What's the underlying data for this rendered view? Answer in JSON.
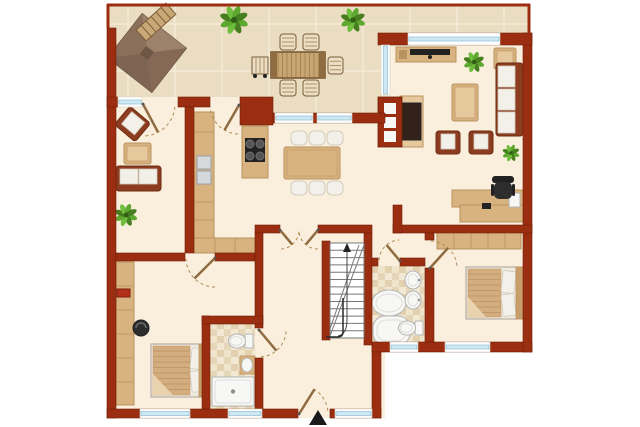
{
  "palette": {
    "wall": "#9B2E11",
    "wallStroke": "#701F08",
    "floor": "#FAEFDC",
    "tile": "#EADDC1",
    "grout": "#F4EBD8",
    "wood": "#D9B37F",
    "woodDark": "#B8925F",
    "woodLight": "#E6C89D",
    "woodDeep": "#8F6C41",
    "outWood": "#C7A674",
    "outWoodDark": "#71502C",
    "slat": "#A8854F",
    "endBoard": "#8F6C41",
    "fabric": "#8C3D20",
    "fabricDark": "#6E2B12",
    "cushion": "#F3F0E9",
    "cushionStroke": "#D3CCBC",
    "white": "#F7F7F5",
    "fixtureStroke": "#B5B5B5",
    "fixtureInner": "#DDDDDD",
    "glass": "#CFE9F4",
    "glassStroke": "#8FBDD3",
    "frame": "#FFFFFF",
    "green1": "#5FA830",
    "green2": "#477F20",
    "green3": "#6FBE3E",
    "greenDark": "#2F5E14",
    "dark": "#222222",
    "chairDark": "#2D2D2D",
    "gray": "#777777",
    "arc": "#B08A58",
    "duvet": "#D3AD7D",
    "duvetStripe": "#C2986A",
    "duvetFold": "#E9D3AE",
    "bathA": "#EFE4CC",
    "bathB": "#E2D0AE",
    "bathC": "#E6D6B8",
    "bathD": "#F2E8D4",
    "pergBase": "#907660",
    "pergN": "#9C816B",
    "pergS": "#7E6553",
    "pergW": "#8A6F5B",
    "pergE": "#866856",
    "pergStroke": "#6A5342",
    "pergCore": "#6F5745",
    "benchWood": "#C9A877",
    "benchStripe": "#7E5E36",
    "outChair": "#EADFC6",
    "outChairStroke": "#7A5B38",
    "outChairStripe": "#B09260",
    "appliance": "#D6D9DB",
    "applianceStroke": "#98A0A6",
    "red": "#B3301A",
    "redStroke": "#7E1E0C",
    "stair": "#FFFFFF",
    "stairLine": "#777777",
    "rail": "#2A2A2A"
  },
  "floorplan": {
    "canvas": {
      "w": 640,
      "h": 427
    },
    "house_floor": [
      {
        "x": 107,
        "y": 97,
        "w": 278,
        "h": 321
      },
      {
        "x": 372,
        "y": 33,
        "w": 160,
        "h": 319
      }
    ],
    "terrace": {
      "path": "M107,4 H530 V33 H381 V113 H240 V97 H107 Z",
      "gridStep": 47,
      "gridX0": 128,
      "gridY0": 24,
      "border": [
        {
          "x1": 107,
          "y1": 5,
          "x2": 530,
          "y2": 5
        },
        {
          "x1": 108,
          "y1": 4,
          "x2": 108,
          "y2": 28
        },
        {
          "x1": 529,
          "y1": 4,
          "x2": 529,
          "y2": 33
        }
      ]
    },
    "bath_floors": [
      {
        "x": 210,
        "y": 324,
        "w": 45,
        "h": 85
      },
      {
        "x": 372,
        "y": 266,
        "w": 53,
        "h": 79
      }
    ],
    "walls": [
      {
        "x": 107,
        "y": 28,
        "w": 9,
        "h": 390
      },
      {
        "x": 107,
        "y": 409,
        "w": 191,
        "h": 9
      },
      {
        "x": 330,
        "y": 409,
        "w": 51,
        "h": 9
      },
      {
        "x": 372,
        "y": 345,
        "w": 9,
        "h": 73
      },
      {
        "x": 372,
        "y": 342,
        "w": 160,
        "h": 10
      },
      {
        "x": 523,
        "y": 33,
        "w": 9,
        "h": 319
      },
      {
        "x": 378,
        "y": 33,
        "w": 154,
        "h": 12
      },
      {
        "x": 107,
        "y": 97,
        "w": 11,
        "h": 10
      },
      {
        "x": 178,
        "y": 97,
        "w": 32,
        "h": 10
      },
      {
        "x": 240,
        "y": 97,
        "w": 33,
        "h": 28
      },
      {
        "x": 273,
        "y": 113,
        "w": 112,
        "h": 10
      },
      {
        "x": 185,
        "y": 107,
        "w": 9,
        "h": 146
      },
      {
        "x": 116,
        "y": 253,
        "w": 69,
        "h": 8
      },
      {
        "x": 215,
        "y": 253,
        "w": 40,
        "h": 8
      },
      {
        "x": 255,
        "y": 225,
        "w": 25,
        "h": 8
      },
      {
        "x": 318,
        "y": 225,
        "w": 54,
        "h": 8
      },
      {
        "x": 393,
        "y": 225,
        "w": 139,
        "h": 8
      },
      {
        "x": 393,
        "y": 205,
        "w": 9,
        "h": 28
      },
      {
        "x": 255,
        "y": 233,
        "w": 8,
        "h": 95
      },
      {
        "x": 255,
        "y": 358,
        "w": 8,
        "h": 51
      },
      {
        "x": 322,
        "y": 241,
        "w": 8,
        "h": 99
      },
      {
        "x": 364,
        "y": 233,
        "w": 8,
        "h": 112
      },
      {
        "x": 372,
        "y": 258,
        "w": 6,
        "h": 8
      },
      {
        "x": 400,
        "y": 258,
        "w": 25,
        "h": 8
      },
      {
        "x": 425,
        "y": 233,
        "w": 9,
        "h": 7
      },
      {
        "x": 425,
        "y": 268,
        "w": 9,
        "h": 74
      },
      {
        "x": 202,
        "y": 316,
        "w": 8,
        "h": 93
      },
      {
        "x": 202,
        "y": 316,
        "w": 61,
        "h": 8
      }
    ],
    "windows": [
      {
        "x": 118,
        "y": 97,
        "w": 24,
        "h": 10,
        "o": "h"
      },
      {
        "x": 275,
        "y": 113,
        "w": 38,
        "h": 10,
        "o": "h"
      },
      {
        "x": 317,
        "y": 113,
        "w": 35,
        "h": 10,
        "o": "h"
      },
      {
        "x": 408,
        "y": 33,
        "w": 92,
        "h": 12,
        "o": "h"
      },
      {
        "x": 381,
        "y": 45,
        "w": 9,
        "h": 50,
        "o": "v"
      },
      {
        "x": 140,
        "y": 409,
        "w": 50,
        "h": 9,
        "o": "h"
      },
      {
        "x": 228,
        "y": 409,
        "w": 34,
        "h": 9,
        "o": "h"
      },
      {
        "x": 335,
        "y": 409,
        "w": 37,
        "h": 9,
        "o": "h"
      },
      {
        "x": 390,
        "y": 342,
        "w": 28,
        "h": 10,
        "o": "h"
      },
      {
        "x": 445,
        "y": 342,
        "w": 45,
        "h": 10,
        "o": "h"
      }
    ],
    "doors": [
      {
        "hx": 143,
        "hy": 104,
        "r": 32,
        "leaf": 62,
        "a0": 5,
        "a1": 90
      },
      {
        "hx": 239,
        "hy": 105,
        "r": 29,
        "leaf": 120,
        "a0": 92,
        "a1": 176
      },
      {
        "hx": 280,
        "hy": 230,
        "r": 19,
        "leaf": 50,
        "a0": 5,
        "a1": 90
      },
      {
        "hx": 318,
        "hy": 230,
        "r": 19,
        "leaf": 130,
        "a0": 90,
        "a1": 175
      },
      {
        "hx": 215,
        "hy": 258,
        "r": 29,
        "leaf": 135,
        "a0": 90,
        "a1": 178
      },
      {
        "hx": 259,
        "hy": 330,
        "r": 27,
        "leaf": 50,
        "a0": 3,
        "a1": 88
      },
      {
        "hx": 400,
        "hy": 261,
        "r": 21,
        "leaf": 230,
        "a0": 182,
        "a1": 268
      },
      {
        "hx": 430,
        "hy": 268,
        "r": 27,
        "leaf": -48,
        "a0": 272,
        "a1": 358
      },
      {
        "hx": 299,
        "hy": 414,
        "r": 29,
        "leaf": -58,
        "a0": 300,
        "a1": 358
      }
    ],
    "stairs": {
      "x": 330,
      "y": 243,
      "w": 34,
      "h": 95,
      "treads": 12
    },
    "entrance_arrow": {
      "points": "309,425 318,410 327,425"
    },
    "furniture": [
      {
        "t": "pergola",
        "name": "pergola",
        "x": 147,
        "y": 53,
        "s": 56,
        "rot": 38
      },
      {
        "t": "bench",
        "name": "garden-bench",
        "x": 156,
        "y": 22,
        "w": 40,
        "h": 15,
        "rot": -42
      },
      {
        "t": "plant",
        "name": "plant",
        "x": 234,
        "y": 20,
        "r": 15
      },
      {
        "t": "plant",
        "name": "plant",
        "x": 353,
        "y": 20,
        "r": 13
      },
      {
        "t": "cart",
        "name": "serving-cart",
        "x": 252,
        "y": 57,
        "w": 16,
        "h": 17
      },
      {
        "t": "otable",
        "name": "outdoor-dining-table",
        "x": 271,
        "y": 52,
        "w": 54,
        "h": 26
      },
      {
        "t": "ochair",
        "name": "outdoor-chair",
        "x": 280,
        "y": 34,
        "w": 16,
        "h": 16
      },
      {
        "t": "ochair",
        "name": "outdoor-chair",
        "x": 303,
        "y": 34,
        "w": 16,
        "h": 16
      },
      {
        "t": "ochair",
        "name": "outdoor-chair",
        "x": 280,
        "y": 80,
        "w": 16,
        "h": 16
      },
      {
        "t": "ochair",
        "name": "outdoor-chair",
        "x": 303,
        "y": 80,
        "w": 16,
        "h": 16
      },
      {
        "t": "ochair",
        "name": "outdoor-chair",
        "x": 328,
        "y": 57,
        "w": 15,
        "h": 17
      },
      {
        "t": "armchair",
        "name": "armchair",
        "x": 119,
        "y": 112,
        "w": 27,
        "h": 24,
        "rot": 40
      },
      {
        "t": "ctable",
        "name": "coffee-table",
        "x": 124,
        "y": 143,
        "w": 27,
        "h": 21
      },
      {
        "t": "sofah",
        "name": "sofa",
        "x": 116,
        "y": 166,
        "w": 45,
        "h": 25
      },
      {
        "t": "plant",
        "name": "plant",
        "x": 126,
        "y": 215,
        "r": 12
      },
      {
        "t": "counter",
        "name": "kitchen-counter",
        "x": 194,
        "y": 112,
        "w": 20,
        "h": 126
      },
      {
        "t": "counterL",
        "name": "kitchen-counter-return",
        "x": 194,
        "y": 238,
        "w": 61,
        "h": 15
      },
      {
        "t": "island",
        "name": "kitchen-island-cooktop",
        "x": 242,
        "y": 126,
        "w": 26,
        "h": 52
      },
      {
        "t": "dining",
        "name": "dining-table-set",
        "x": 284,
        "y": 147,
        "w": 56,
        "h": 32
      },
      {
        "t": "sideboard",
        "name": "tv-sideboard",
        "x": 396,
        "y": 47,
        "w": 60,
        "h": 15
      },
      {
        "t": "plant",
        "name": "plant",
        "x": 474,
        "y": 62,
        "r": 11
      },
      {
        "t": "sidetable",
        "name": "side-table",
        "x": 494,
        "y": 48,
        "w": 22,
        "h": 21
      },
      {
        "t": "sofav",
        "name": "sofa",
        "x": 496,
        "y": 63,
        "w": 27,
        "h": 73
      },
      {
        "t": "ctable",
        "name": "coffee-table",
        "x": 452,
        "y": 84,
        "w": 26,
        "h": 37
      },
      {
        "t": "armchair",
        "name": "armchair",
        "x": 436,
        "y": 131,
        "w": 24,
        "h": 23,
        "rot": 0
      },
      {
        "t": "armchair",
        "name": "armchair",
        "x": 469,
        "y": 131,
        "w": 24,
        "h": 23,
        "rot": 0
      },
      {
        "t": "plant",
        "name": "plant",
        "x": 511,
        "y": 153,
        "r": 9
      },
      {
        "t": "fireplace",
        "name": "fireplace",
        "x": 378,
        "y": 96
      },
      {
        "t": "desk",
        "name": "desk",
        "x": 452,
        "y": 190
      },
      {
        "t": "officechair",
        "name": "office-chair",
        "x": 492,
        "y": 176
      },
      {
        "t": "wardrobeV",
        "name": "wardrobe",
        "x": 116,
        "y": 262,
        "w": 18,
        "h": 143
      },
      {
        "t": "redbox",
        "name": "storage-box",
        "x": 117,
        "y": 289,
        "w": 13,
        "h": 8
      },
      {
        "t": "stool",
        "name": "stool",
        "x": 141,
        "y": 328,
        "r": 8
      },
      {
        "t": "bed",
        "name": "double-bed",
        "x": 151,
        "y": 344,
        "w": 54,
        "h": 53
      },
      {
        "t": "toilet",
        "name": "toilet",
        "x": 236,
        "y": 341,
        "rot": 90
      },
      {
        "t": "sinkshelf",
        "name": "sink",
        "x": 240,
        "y": 356,
        "w": 15,
        "h": 18
      },
      {
        "t": "shower",
        "name": "shower-tray",
        "x": 212,
        "y": 377,
        "w": 42,
        "h": 29
      },
      {
        "t": "roundshower",
        "name": "corner-shower",
        "x": 389,
        "y": 303,
        "rx": 17,
        "ry": 13
      },
      {
        "t": "cornertub",
        "name": "bathtub",
        "x": 373,
        "y": 316,
        "w": 37,
        "h": 29
      },
      {
        "t": "sink",
        "name": "sink",
        "x": 413,
        "y": 280
      },
      {
        "t": "sink",
        "name": "sink",
        "x": 413,
        "y": 300
      },
      {
        "t": "toilet",
        "name": "toilet",
        "x": 406,
        "y": 328,
        "rot": 90
      },
      {
        "t": "wardrobeH",
        "name": "wardrobe",
        "x": 437,
        "y": 232,
        "w": 84,
        "h": 17
      },
      {
        "t": "bed2",
        "name": "double-bed",
        "x": 466,
        "y": 267,
        "w": 57,
        "h": 52
      }
    ]
  }
}
